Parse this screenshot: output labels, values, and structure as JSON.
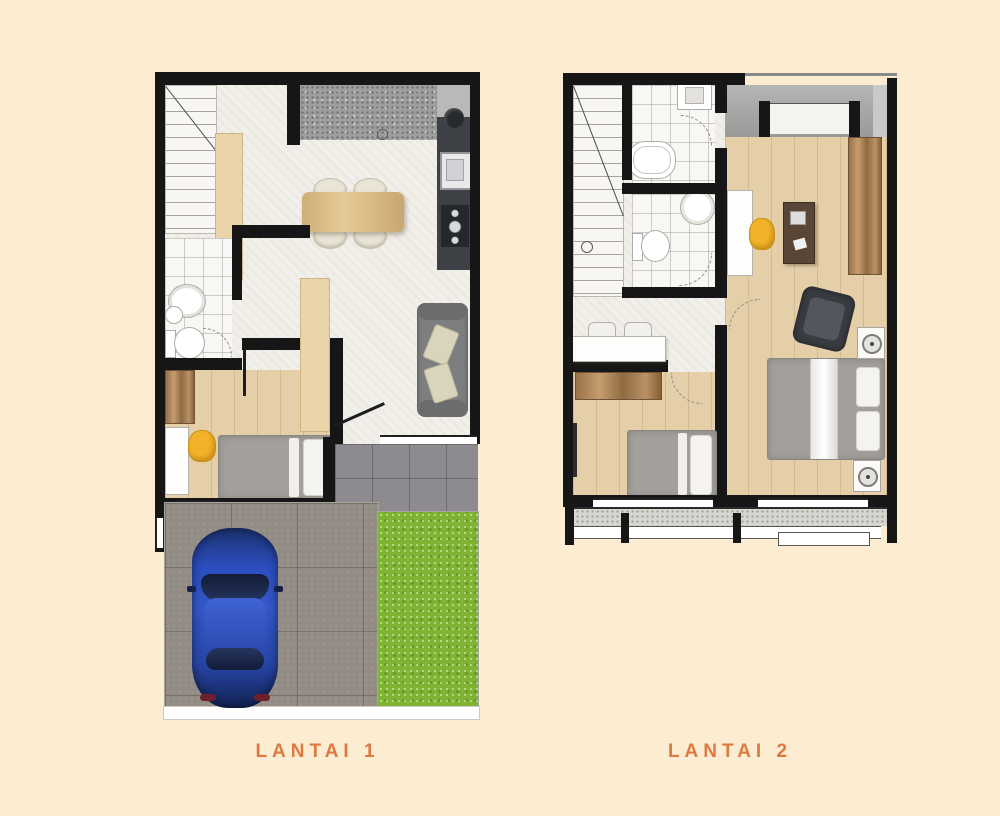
{
  "page": {
    "background": "#fcecd2"
  },
  "plans": [
    {
      "id": "lantai-1",
      "label": "LANTAI 1"
    },
    {
      "id": "lantai-2",
      "label": "LANTAI 2"
    }
  ],
  "colors": {
    "bg": "#fcecd2",
    "label": "#dd7a41",
    "wall": "#161616",
    "floor": "#f1efe9",
    "wood_floor": "#e4cfa9",
    "beige_cabinet": "#ead5ab",
    "counter_dark": "#3d4045",
    "counter_light": "#b9b9b9",
    "terrace_tile": "#8d8b90",
    "paving": "#928c85",
    "grass": "#7fb335",
    "sofa": "#7c7e80",
    "bed": "#a3a09b",
    "accent_yellow": "#f2b32a",
    "car_blue": "#2b4ec0",
    "dark_desk": "#5a4636"
  }
}
